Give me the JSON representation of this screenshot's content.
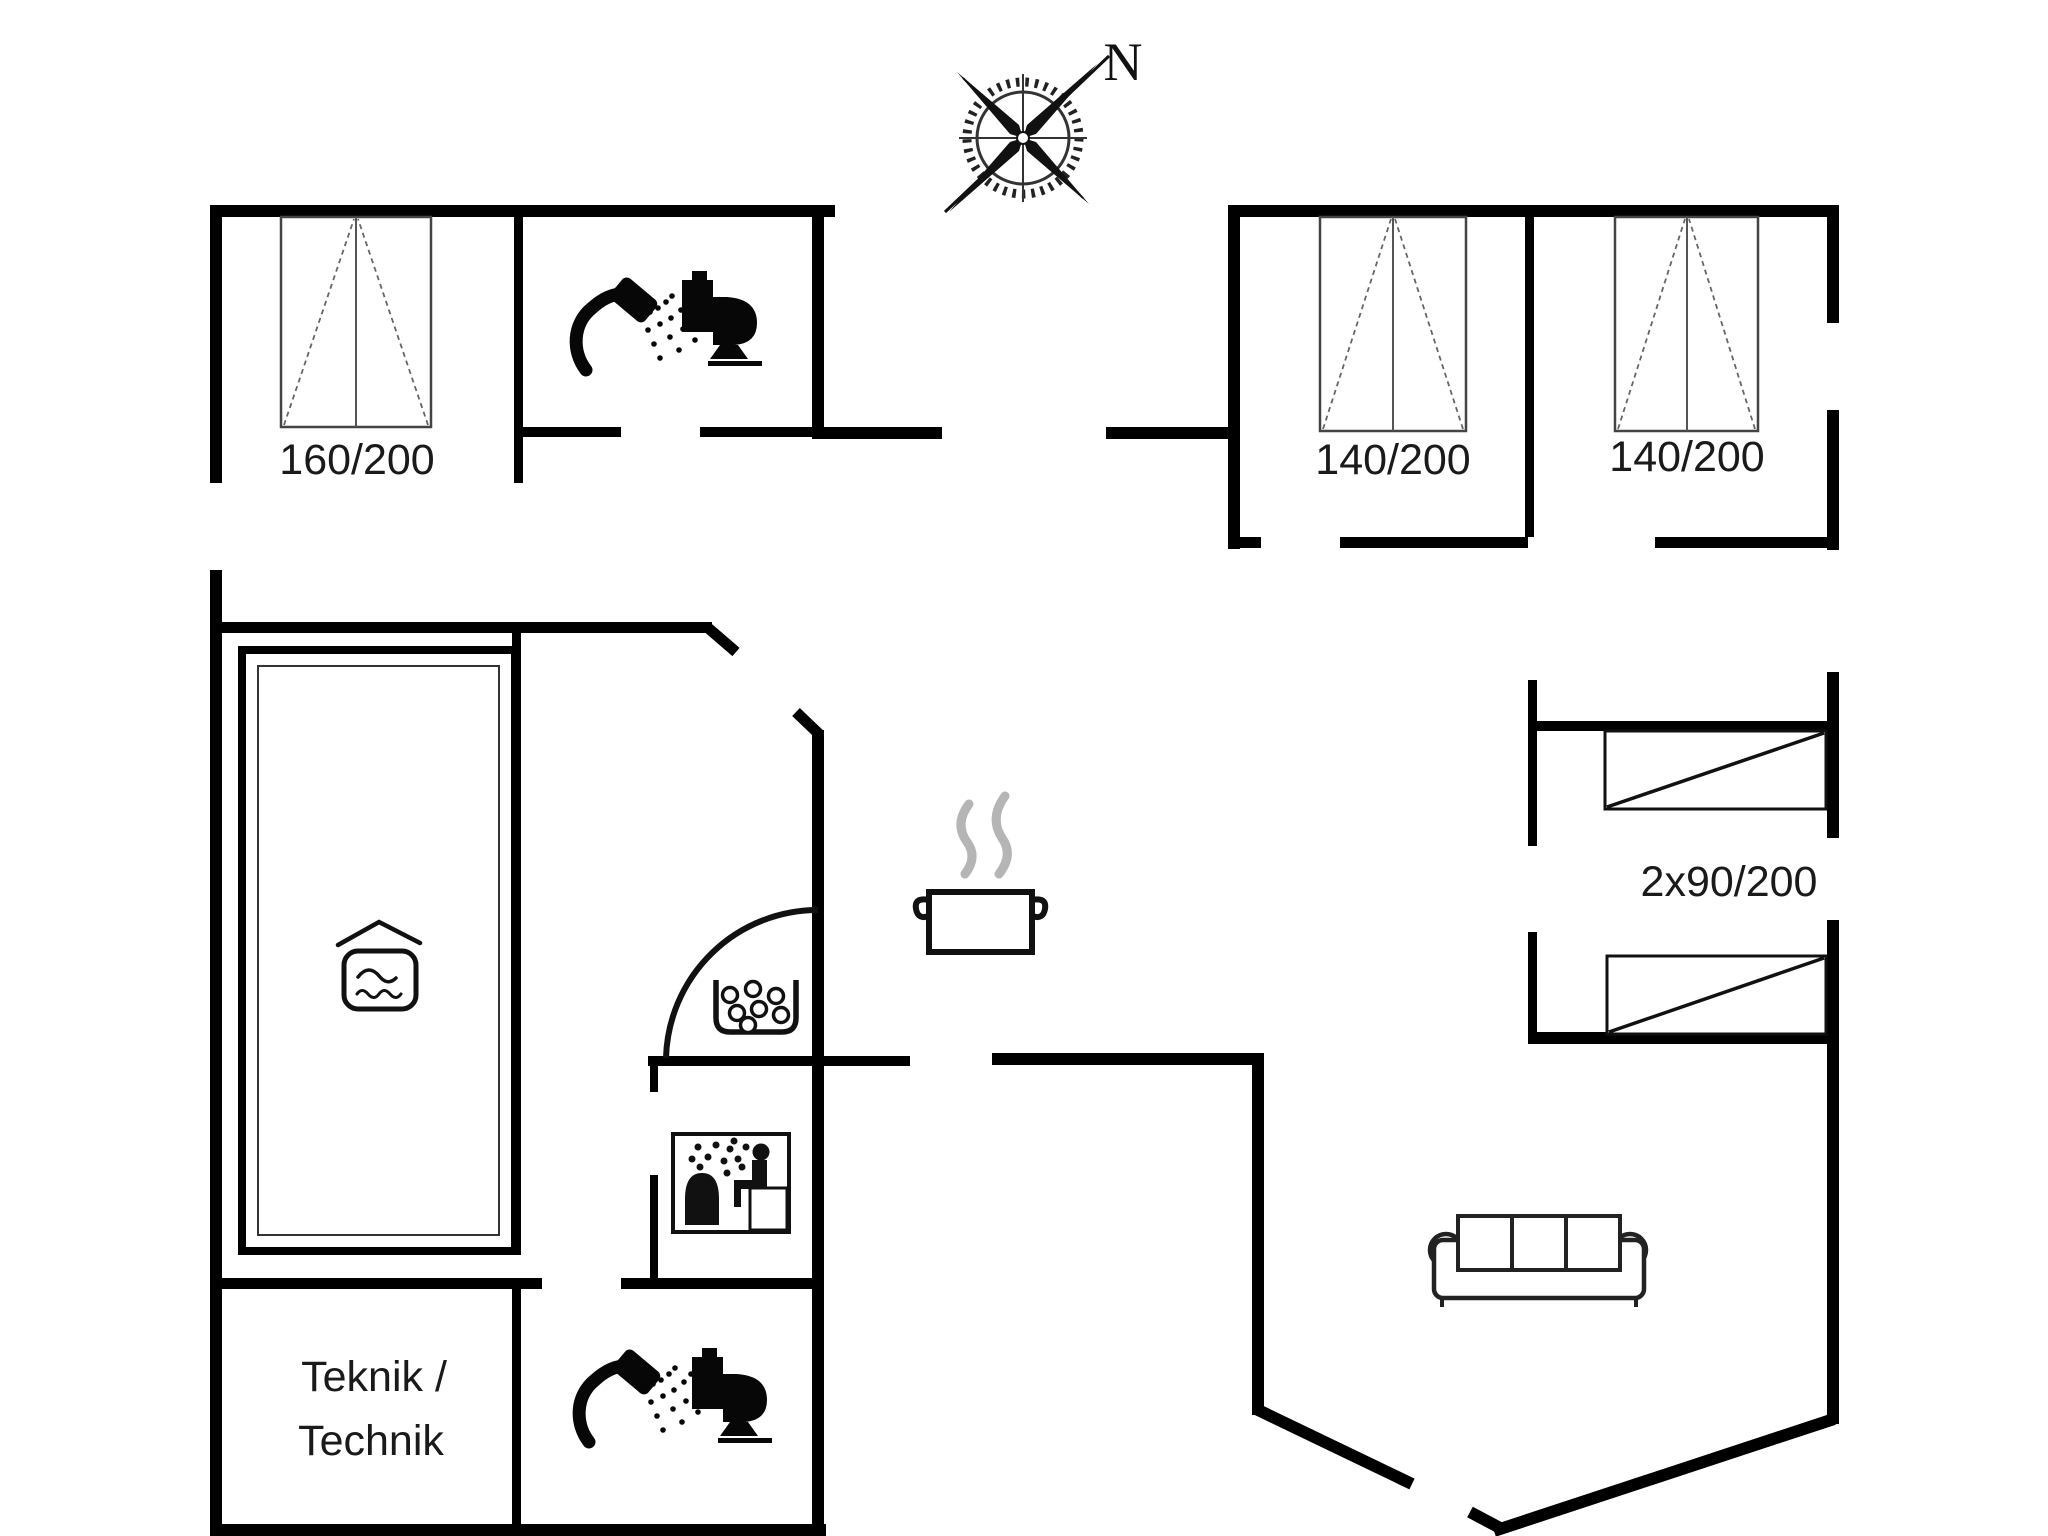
{
  "compass": {
    "north_label": "N"
  },
  "labels": {
    "bed_master": "160/200",
    "bed_double_1": "140/200",
    "bed_double_2": "140/200",
    "bunk_beds": "2x90/200",
    "technical_room_line1": "Teknik /",
    "technical_room_line2": "Technik"
  },
  "icons": {
    "compass": "compass-rose-icon",
    "shower": "shower-icon",
    "toilet": "toilet-icon",
    "pool": "pool-waves-icon",
    "whirlpool": "bubbles-icon",
    "sauna": "sauna-icon",
    "kitchen": "pot-steam-icon",
    "sofa": "sofa-icon",
    "door": "door-swing-arc"
  },
  "colors": {
    "wall": "#000000",
    "line": "#111111",
    "bed_outline": "#444444",
    "dash_line": "#666666",
    "steam_gray": "#b5b5b5",
    "label_text": "#1a1a1a",
    "background": "#ffffff"
  }
}
